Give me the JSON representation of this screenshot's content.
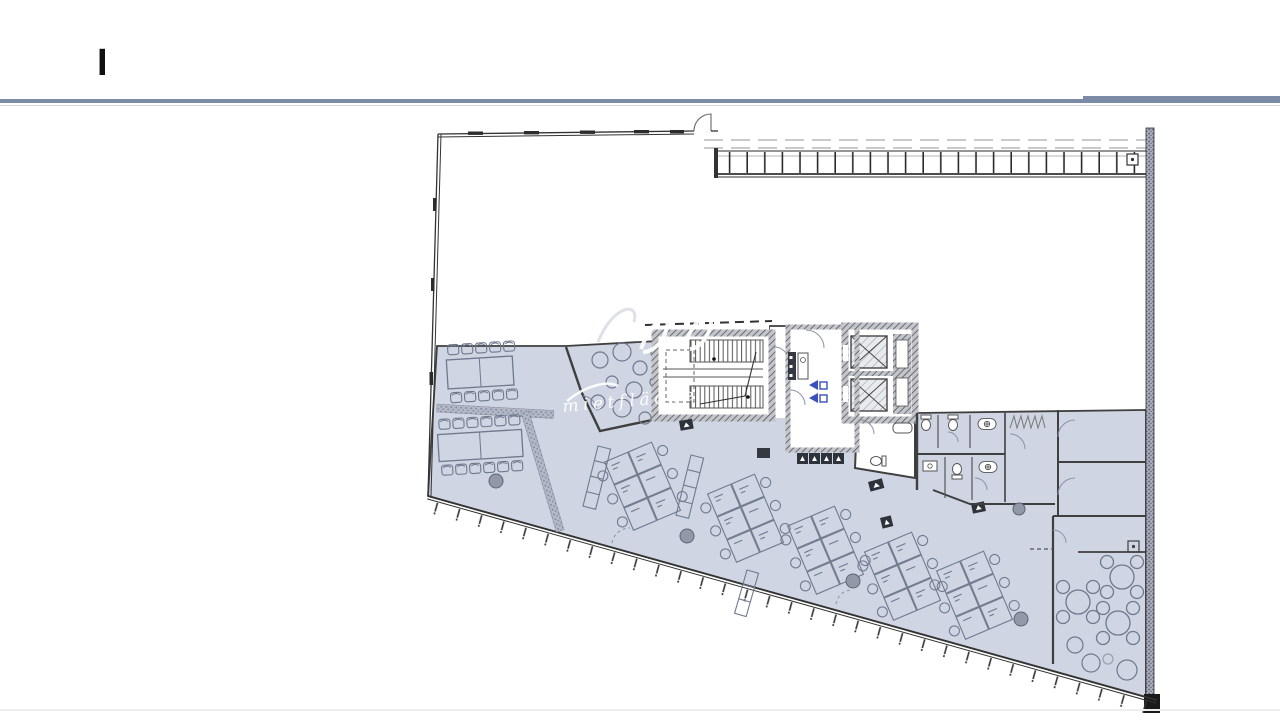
{
  "slide": {
    "title_text": "I"
  },
  "watermark": {
    "text": "mietfläche"
  },
  "colors": {
    "rule": "#7d8ca6",
    "area_fill": "#cfd5e2",
    "wall": "#3f3f3f",
    "furniture": "#6f788c",
    "column": "#9298a8",
    "accent_blue": "#3a50bd",
    "exit_sign": "#2e323a"
  },
  "plan": {
    "features": [
      "meeting-room-1",
      "meeting-room-2",
      "lounge-circles",
      "stair-core",
      "elevator-shafts",
      "elevator-lobby",
      "kitchenette",
      "bathroom",
      "wc-block",
      "office-rooms",
      "open-office-desk-clusters",
      "sideboards",
      "columns",
      "cafe-seating",
      "terrace-with-mullions",
      "window-wall-ticks"
    ]
  }
}
